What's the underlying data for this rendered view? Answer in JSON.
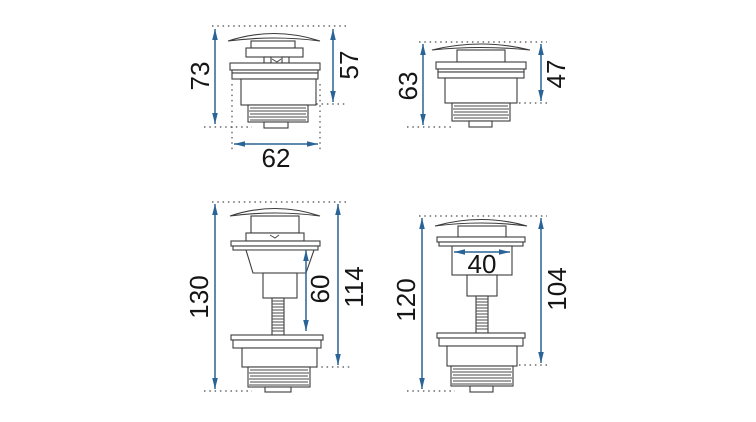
{
  "canvas": {
    "background": "#ffffff"
  },
  "style": {
    "dimension_color": "#2a6496",
    "outline_color": "#3c3c3c",
    "label_color": "#151515"
  },
  "diagrams": [
    {
      "position": "top-left",
      "dimensions": {
        "total_height": "73",
        "body_height": "57",
        "body_width": "62"
      }
    },
    {
      "position": "top-right",
      "dimensions": {
        "total_height": "63",
        "body_height": "47"
      }
    },
    {
      "position": "bottom-left",
      "dimensions": {
        "total_height": "130",
        "stem_length": "60",
        "body_height": "114"
      }
    },
    {
      "position": "bottom-right",
      "dimensions": {
        "total_height": "120",
        "cap_stem_width": "40",
        "body_height": "104"
      }
    }
  ]
}
